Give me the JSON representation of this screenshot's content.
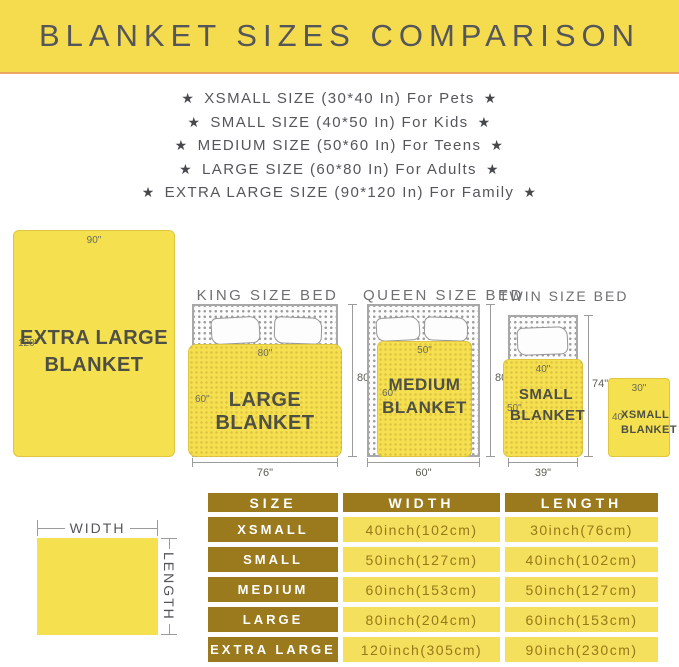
{
  "banner": {
    "title": "BLANKET SIZES COMPARISON"
  },
  "star": "★",
  "size_list": [
    "XSMALL SIZE (30*40 In) For Pets",
    "SMALL SIZE (40*50 In) For Kids",
    "MEDIUM SIZE (50*60 In) For Teens",
    "LARGE SIZE (60*80 In) For Adults",
    "EXTRA LARGE SIZE (90*120 In) For Family"
  ],
  "diagrams": {
    "extra_large": {
      "width": "90\"",
      "length": "120\"",
      "label_line1": "EXTRA LARGE",
      "label_line2": "BLANKET"
    },
    "king": {
      "bed_title": "KING SIZE BED",
      "blanket_width": "80\"",
      "blanket_length": "60\"",
      "blanket_label": "LARGE BLANKET",
      "bed_width": "76\"",
      "bed_length": "80\""
    },
    "queen": {
      "bed_title": "QUEEN SIZE BED",
      "blanket_width": "50\"",
      "blanket_length": "60\"",
      "label_line1": "MEDIUM",
      "label_line2": "BLANKET",
      "bed_width": "60\"",
      "bed_length": "80\""
    },
    "twin": {
      "bed_title": "TWIN SIZE BED",
      "blanket_width": "40\"",
      "blanket_length": "50\"",
      "label_line1": "SMALL",
      "label_line2": "BLANKET",
      "bed_width": "39\"",
      "bed_length": "74\""
    },
    "xsmall": {
      "width": "30\"",
      "length": "40\"",
      "label_line1": "XSMALL",
      "label_line2": "BLANKET"
    }
  },
  "legend": {
    "width": "WIDTH",
    "length": "LENGTH"
  },
  "table": {
    "headers": [
      "SIZE",
      "WIDTH",
      "LENGTH"
    ],
    "rows": [
      {
        "size": "XSMALL",
        "width": "40inch(102cm)",
        "length": "30inch(76cm)"
      },
      {
        "size": "SMALL",
        "width": "50inch(127cm)",
        "length": "40inch(102cm)"
      },
      {
        "size": "MEDIUM",
        "width": "60inch(153cm)",
        "length": "50inch(127cm)"
      },
      {
        "size": "LARGE",
        "width": "80inch(204cm)",
        "length": "60inch(153cm)"
      },
      {
        "size": "EXTRA LARGE",
        "width": "120inch(305cm)",
        "length": "90inch(230cm)"
      }
    ]
  },
  "colors": {
    "banner_bg": "#f5dc4e",
    "banner_line": "#e9a660",
    "heading_text": "#55565a",
    "blanket_yellow": "#f5e14f",
    "blanket_text": "#4e4f45",
    "bed_border": "#a8a8a8",
    "dim_line": "#9b9b9b",
    "table_gold": "#9a7a1c",
    "table_cell_yellow": "#f4e05c",
    "table_cell_text": "#97781a"
  }
}
